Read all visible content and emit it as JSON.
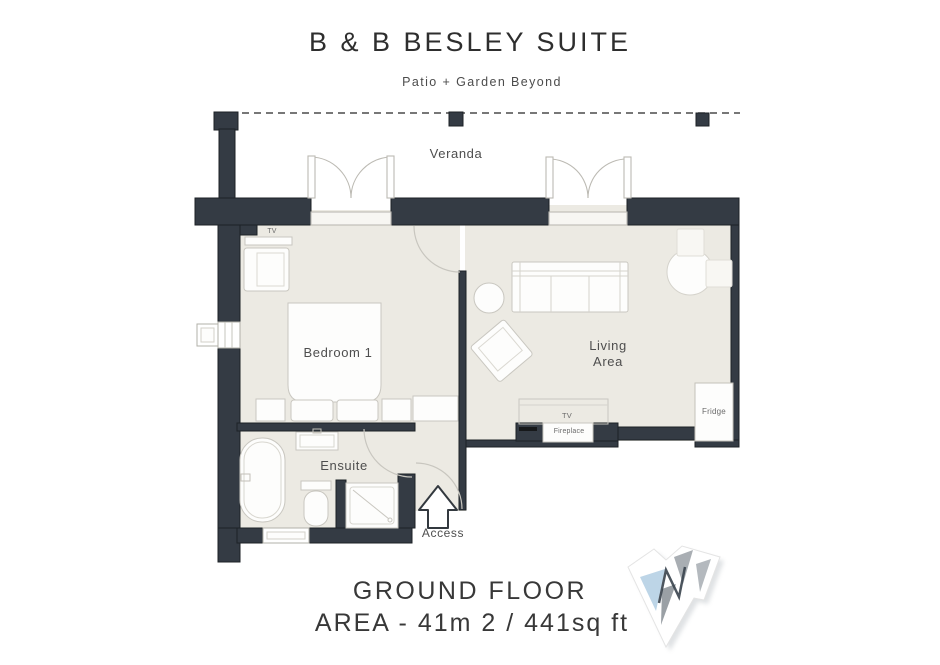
{
  "header": {
    "title": "B & B BESLEY SUITE",
    "subtitle": "Patio + Garden Beyond"
  },
  "plan": {
    "veranda_label": "Veranda",
    "bedroom_label": "Bedroom 1",
    "living_label_line1": "Living",
    "living_label_line2": "Area",
    "ensuite_label": "Ensuite",
    "access_label": "Access",
    "bedroom_tv_label": "TV",
    "living_tv_label": "TV",
    "fireplace_label": "Fireplace",
    "fridge_label": "Fridge"
  },
  "footer": {
    "floor_label": "GROUND FLOOR",
    "area_label": "AREA - 41m 2 / 441sq ft"
  },
  "colors": {
    "wall": "#343b44",
    "floor": "#eceae3",
    "logo_blue": "#bdd5e7",
    "logo_gray": "#a9aeb3",
    "logo_gray_dark": "#9aa0a5",
    "text": "#3a3a3a"
  }
}
